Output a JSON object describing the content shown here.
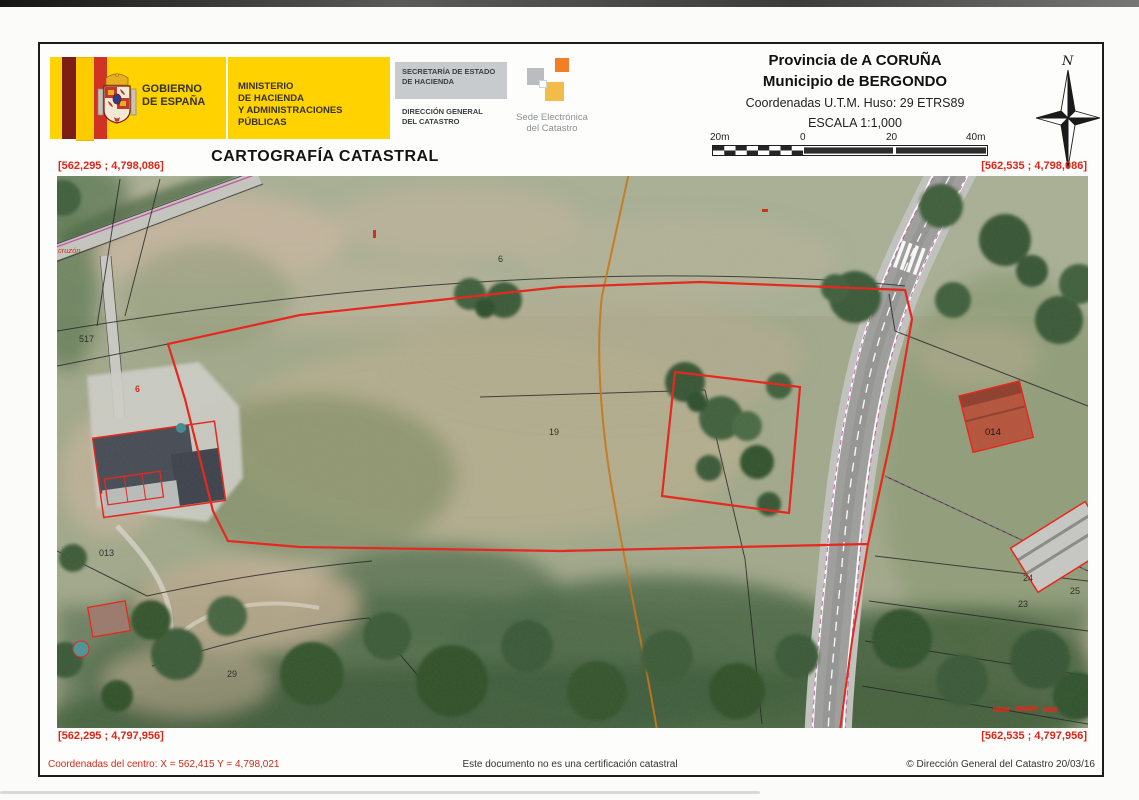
{
  "page": {
    "title": "CARTOGRAFÍA CATASTRAL"
  },
  "header": {
    "gobierno": {
      "line1": "GOBIERNO",
      "line2": "DE ESPAÑA"
    },
    "ministerio": {
      "line1": "MINISTERIO",
      "line2": "DE HACIENDA",
      "line3": "Y ADMINISTRACIONES PÚBLICAS"
    },
    "secretaria": {
      "line1": "SECRETARÍA DE ESTADO",
      "line2": "DE HACIENDA"
    },
    "direccion": {
      "line1": "DIRECCIÓN GENERAL",
      "line2": "DEL CATASTRO"
    },
    "sede": {
      "line1": "Sede Electrónica",
      "line2": "del Catastro"
    }
  },
  "map_info": {
    "provincia": "Provincia de A CORUÑA",
    "municipio": "Municipio de BERGONDO",
    "coordenadas": "Coordenadas U.T.M. Huso: 29 ETRS89",
    "escala": "ESCALA 1:1,000",
    "scale_labels": {
      "a": "20m",
      "b": "0",
      "c": "20",
      "d": "40m"
    },
    "north": "N"
  },
  "corners": {
    "top_left": "[562,295 ; 4,798,086]",
    "top_right": "[562,535 ; 4,798,086]",
    "bottom_left": "[562,295 ; 4,797,956]",
    "bottom_right": "[562,535 ; 4,797,956]"
  },
  "map_labels": {
    "p517": "517",
    "p013": "013",
    "p19": "19",
    "p6": "6",
    "p014": "014",
    "p24": "24",
    "p23": "23",
    "p25": "25",
    "p29": "29",
    "red6": "6",
    "road_name": "cruzón"
  },
  "footer": {
    "left": "Coordenadas del centro: X = 562,415 Y = 4,798,021",
    "center": "Este documento no es una certificación catastral",
    "right": "© Dirección General del Catastro 20/03/16"
  },
  "colors": {
    "cadastral_red": "#e02518",
    "gov_yellow": "#ffd200",
    "sede_orange": "#f07f28",
    "sede_yellow": "#f2bc4a",
    "sede_gray": "#b9bdbf"
  }
}
